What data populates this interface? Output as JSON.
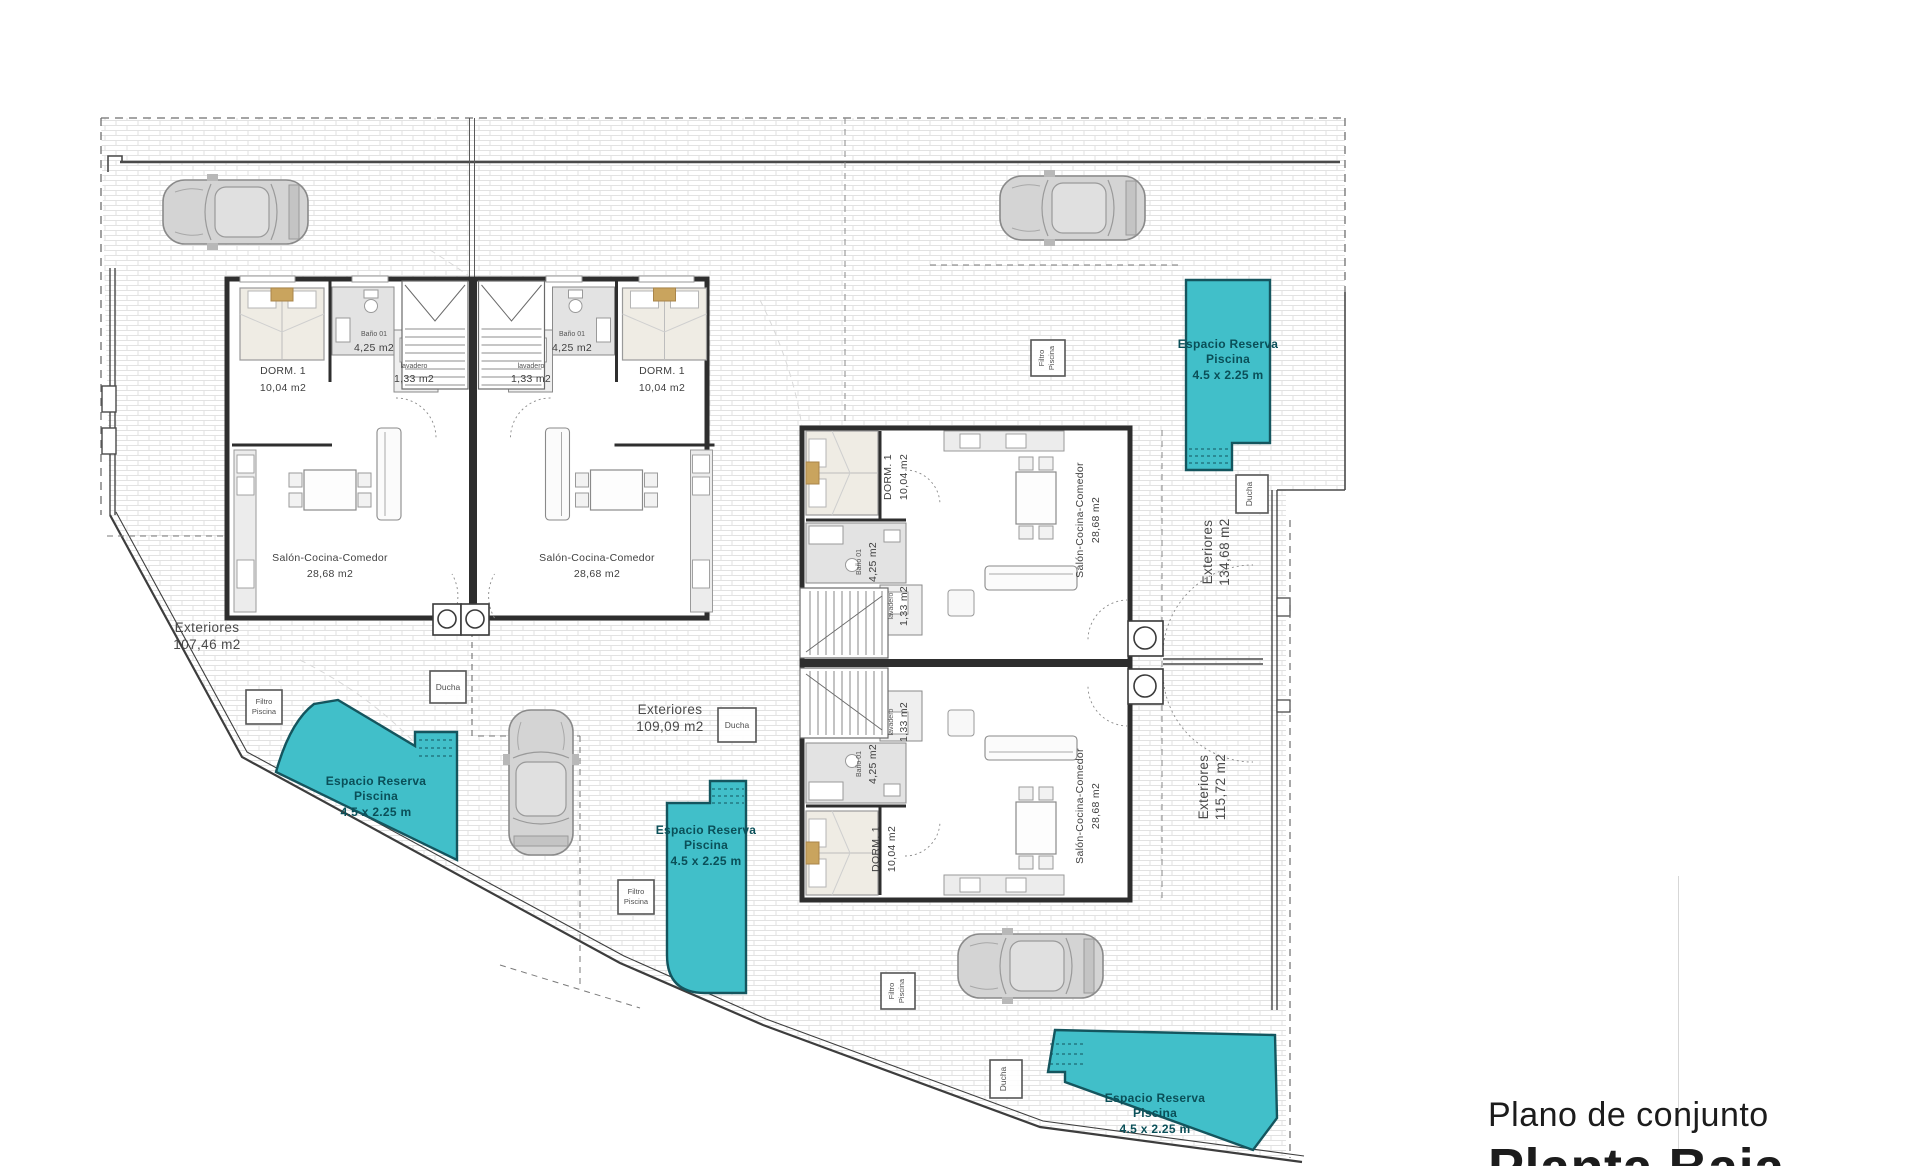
{
  "plan": {
    "title": {
      "line1": "Plano de conjunto",
      "line2": "Planta Baja"
    },
    "rooms": {
      "dorm": {
        "name": "DORM. 1",
        "area": "10,04 m2"
      },
      "bano": {
        "name": "Baño 01",
        "area": "4,25 m2"
      },
      "lavadero": {
        "name": "lavadero",
        "area": "1,33 m2"
      },
      "salon": {
        "name": "Salón-Cocina-Comedor",
        "area": "28,68 m2"
      }
    },
    "exteriors": {
      "left": {
        "label": "Exteriores",
        "area": "107,46 m2"
      },
      "center": {
        "label": "Exteriores",
        "area": "109,09 m2"
      },
      "right_upper": {
        "label": "Exteriores",
        "area": "134,68 m2"
      },
      "right_lower": {
        "label": "Exteriores",
        "area": "115,72 m2"
      }
    },
    "pool_reserve": {
      "line1": "Espacio Reserva",
      "line2": "Piscina",
      "line3": "4.5 x 2.25 m"
    },
    "pool_filter": {
      "line1": "Filtro",
      "line2": "Piscina"
    },
    "shower": {
      "label": "Ducha"
    },
    "colors": {
      "pool_fill": "#41bfc9",
      "pool_stroke": "#14555e",
      "pool_text": "#0a4f58",
      "wall": "#2e2e2e",
      "bed_accent": "#c9a45e",
      "brick_line": "#e2e2e2"
    }
  }
}
